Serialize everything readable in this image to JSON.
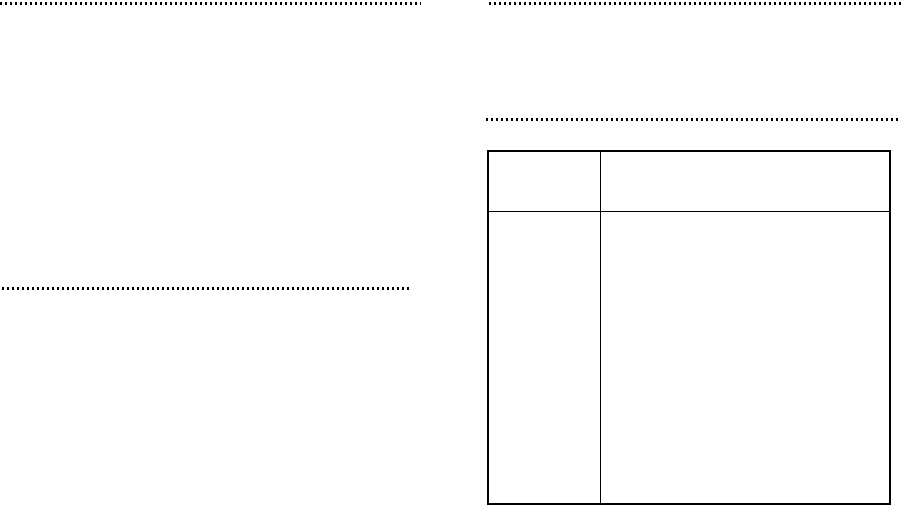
{
  "page": {
    "background_color": "#ffffff",
    "rule_color": "#000000"
  },
  "dotted_rules": [
    {
      "name": "top-left-rule"
    },
    {
      "name": "top-right-rule"
    },
    {
      "name": "mid-right-rule"
    },
    {
      "name": "mid-left-rule"
    }
  ],
  "table": {
    "border_color": "#000000",
    "header": [
      "",
      ""
    ],
    "rows": [
      [
        "",
        ""
      ]
    ]
  }
}
